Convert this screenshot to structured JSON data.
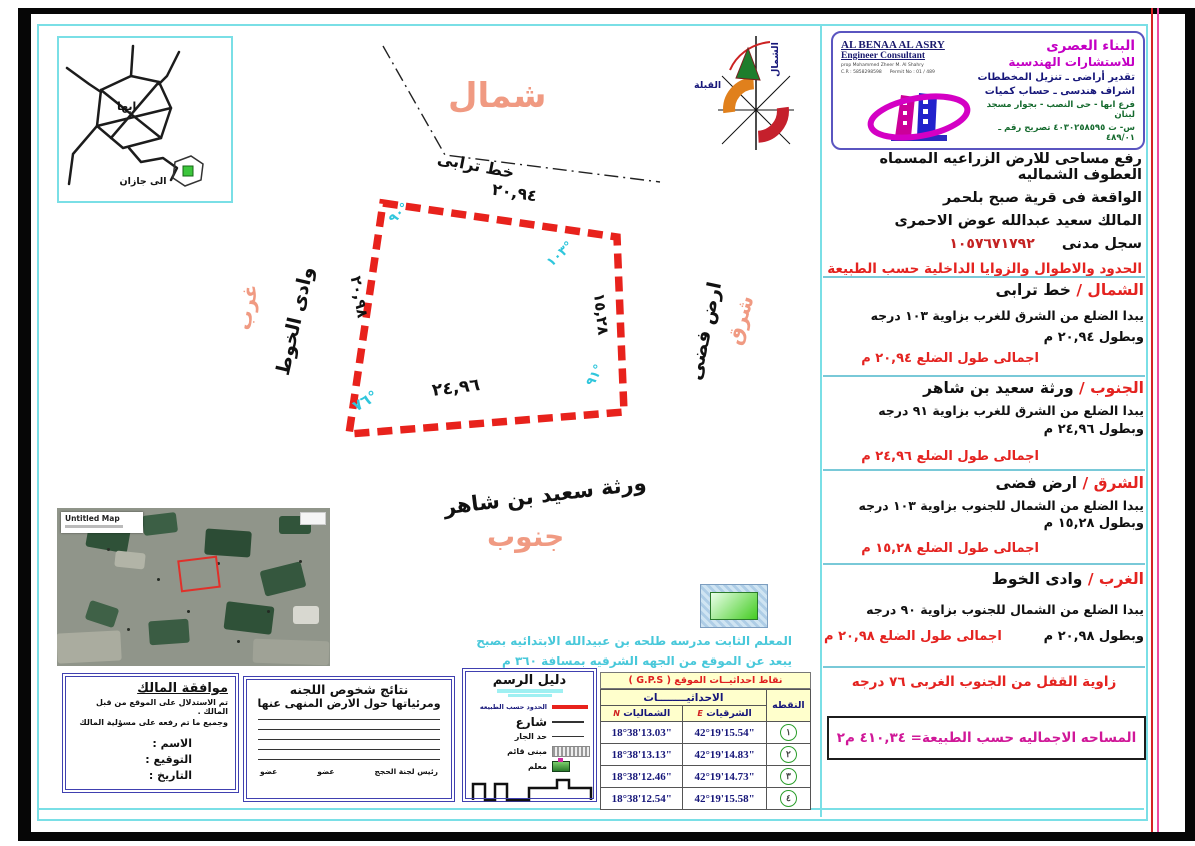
{
  "colors": {
    "boundary_red": "#e8221c",
    "direction_salmon": "#f09a82",
    "angle_cyan": "#2fc6dc",
    "frame_cyan": "#7adfe6",
    "brand_magenta": "#c400c4",
    "area_magenta": "#d01898",
    "table_header_bg": "#ffffcc",
    "marker_green": "#44cc44"
  },
  "inset_map": {
    "city": "ابها",
    "to_jazan": "الى جازان"
  },
  "compass": {
    "north": "الشمال",
    "qibla": "القبلة"
  },
  "drawing": {
    "north_word": "شمال",
    "south_word": "جنوب",
    "east_word": "شرق",
    "west_word": "غرب",
    "dirt_road": "خط ترابى",
    "top_length": "٢٠,٩٤",
    "bottom_length": "٢٤,٩٦",
    "left_length": "٢٠,٩٨",
    "right_length": "١٥,٢٨",
    "angle_top_left": "٩٠°",
    "angle_top_right": "١٠٣°",
    "angle_bottom_right": "٩١°",
    "angle_bottom_left": "٧٦°",
    "west_neighbor": "وادى الخوط",
    "east_neighbor": "ارض فضى",
    "south_neighbor": "ورثة سعيد بن شاهر"
  },
  "satellite": {
    "title": "Untitled Map"
  },
  "landmark": {
    "line1": "المعلم الثابت مدرسه طلحه بن عبيدالله الابتدائيه بصبح",
    "line2": "يبعد عن الموقع من الجهه الشرقيه بمسافة ٣٦٠ م"
  },
  "header": {
    "en_name": "AL BENAA AL ASRY",
    "en_title": "Engineer Consultant",
    "en_prop": "prop Mohammed Zheer M. Al Shahry",
    "en_cr": "C.R : 5858298598",
    "en_permit": "Permit No : 01 / 489",
    "ar_name": "البناء العصرى",
    "ar_title": "للاستشارات الهندسية",
    "service1": "تقدير أراضى ـ تنزيل المخططات",
    "service2": "اشراف هندسى ـ حساب كميات",
    "address1": "فرع ابها - حى النصب - بجوار مسجد لبنان",
    "address2": "س- ت ٤٠٣٠٢٥٨٥٩٥ تصريح رقم ـ ٤٨٩/٠١"
  },
  "intro": {
    "line1": "رفع مساحى للارض الزراعيه المسماه العطوف الشماليه",
    "line2": "الواقعة فى قرية صبح بلحمر",
    "line3": "المالك سعيد عبدالله عوض الاحمرى",
    "civil_label": "سجل مدنى",
    "civil_number": "١٠٥٧٦٧١٧٩٢",
    "red_note": "الحدود والاطوال والزوايا الداخلية حسب الطبيعة"
  },
  "sections": [
    {
      "name": "الشمال /",
      "boundary": "خط ترابى",
      "desc": "يبدا الضلع من الشرق للغرب بزاوية ١٠٣ درجه",
      "length": "وبطول ٢٠,٩٤ م",
      "total": "اجمالى طول الضلع ٢٠,٩٤ م"
    },
    {
      "name": "الجنوب /",
      "boundary": "ورثة سعيد بن شاهر",
      "desc": "يبدا الضلع من الشرق للغرب بزاوية ٩١ درجه",
      "length": "وبطول ٢٤,٩٦ م",
      "total": "اجمالى طول الضلع ٢٤,٩٦ م"
    },
    {
      "name": "الشرق /",
      "boundary": "ارض فضى",
      "desc": "يبدا الضلع من الشمال للجنوب بزاوية ١٠٣ درجه",
      "length": "وبطول ١٥,٢٨ م",
      "total": "اجمالى طول الضلع ١٥,٢٨ م"
    },
    {
      "name": "الغرب /",
      "boundary": "وادى الخوط",
      "desc": "يبدا الضلع من الشمال للجنوب بزاوية ٩٠ درجه",
      "length": "وبطول ٢٠,٩٨ م",
      "total": "اجمالى طول الضلع ٢٠,٩٨ م"
    }
  ],
  "closing_angle": "زاوية القفل من الجنوب الغربى ٧٦ درجه",
  "total_area": "المساحه الاجماليه حسب الطبيعة= ٤١٠,٣٤ م٢",
  "owner_box": {
    "title": "موافقة المالك",
    "line1": "تم الاستدلال على الموقع من قبل المالك .",
    "line2": "وجميع ما تم رفعه على مسؤلية المالك",
    "name_label": "الاسم :",
    "signature_label": "التوقيع :",
    "date_label": "التاريخ :"
  },
  "committee_box": {
    "title_line1": "نتائج شخوص اللجنه",
    "title_line2": "ومرئياتها حول الارض المنهى عنها",
    "member1": "عضو",
    "member2": "عضو",
    "chairman": "رئيس لجنة الحجج"
  },
  "legend_box": {
    "title": "دليل الرسم",
    "items": [
      {
        "label": "الحدود حسب الطبيعه"
      },
      {
        "label": "شارع"
      },
      {
        "label": "حد الجار"
      },
      {
        "label": "مبنى قائم"
      },
      {
        "label": "معلم"
      }
    ]
  },
  "gps": {
    "title": "نقاط احداثيــات الموقع ( G.P.S )",
    "point_header": "النقطه",
    "coords_header": "الاحداثيــــــــات",
    "east_header": "الشرقيات",
    "east_letter": "E",
    "north_header": "الشماليات",
    "north_letter": "N",
    "rows": [
      {
        "point": "١",
        "east": "42°19'15.54\"",
        "north": "18°38'13.03\""
      },
      {
        "point": "٢",
        "east": "42°19'14.83\"",
        "north": "18°38'13.13\""
      },
      {
        "point": "٣",
        "east": "42°19'14.73\"",
        "north": "18°38'12.46\""
      },
      {
        "point": "٤",
        "east": "42°19'15.58\"",
        "north": "18°38'12.54\""
      }
    ]
  }
}
